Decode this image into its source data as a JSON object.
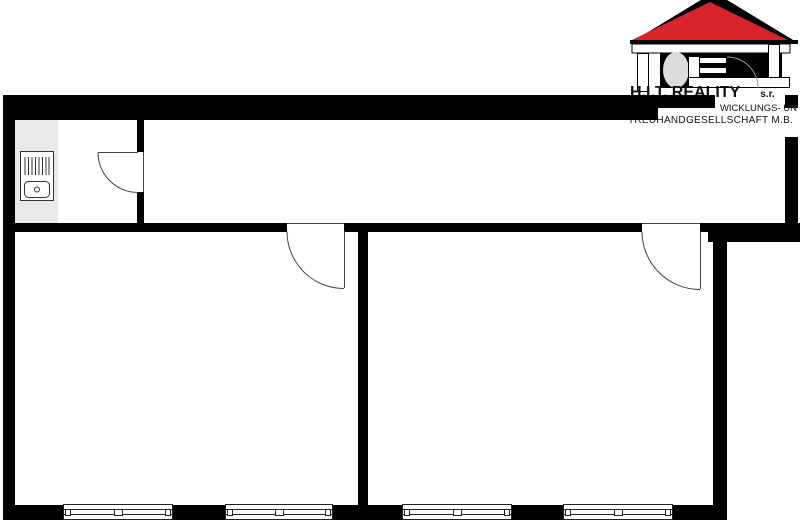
{
  "logo": {
    "line1": "H.I.T. REALITY",
    "line1_suffix": "s.r.",
    "line2": "WICKLUNGS- UN",
    "line3": "TREUHANDGESELLSCHAFT M.B.",
    "colors": {
      "roof_red": "#D8232A",
      "shadow_black": "#000000",
      "fingerprint_gray": "#DBDBDB",
      "beam_white": "#FFFFFF",
      "arc_gray": "#999999"
    }
  },
  "floorplan": {
    "colors": {
      "wall_black": "#000000",
      "kitchen_gray": "#E9E9E9",
      "thin_line_gray": "#444444",
      "background_white": "#FFFFFF"
    },
    "symbols": {
      "appliance_icon": "kitchen-stove-sink-unit",
      "door_symbol": "quarter-arc-door-swing",
      "window_symbol": "triple-line-window"
    }
  }
}
